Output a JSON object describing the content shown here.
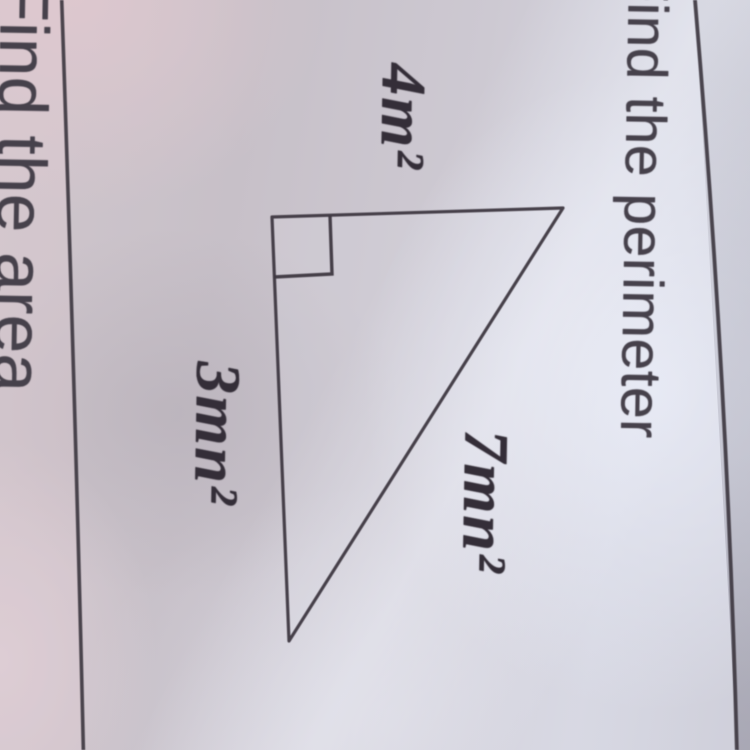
{
  "photo": {
    "type": "photograph of printed math worksheet",
    "orientation": "page rotated 90 degrees clockwise in photo"
  },
  "main_problem": {
    "title": "Find the perimeter",
    "figure": {
      "shape": "right triangle",
      "has_right_angle_marker": true,
      "side_labels": {
        "top_leg": "4m²",
        "left_leg": "3mn²",
        "hypotenuse": "7mn²"
      }
    }
  },
  "adjacent_problem": {
    "title": "Find the area"
  },
  "colors": {
    "ink": "#3e3841",
    "label_ink": "#342e38",
    "title_ink": "#46414b",
    "paper_base": "#c8c2ca",
    "paper_pink": "#d6c6cc",
    "paper_highlight": "#d9dae5",
    "paper_shadow": "#b4aeb8"
  }
}
